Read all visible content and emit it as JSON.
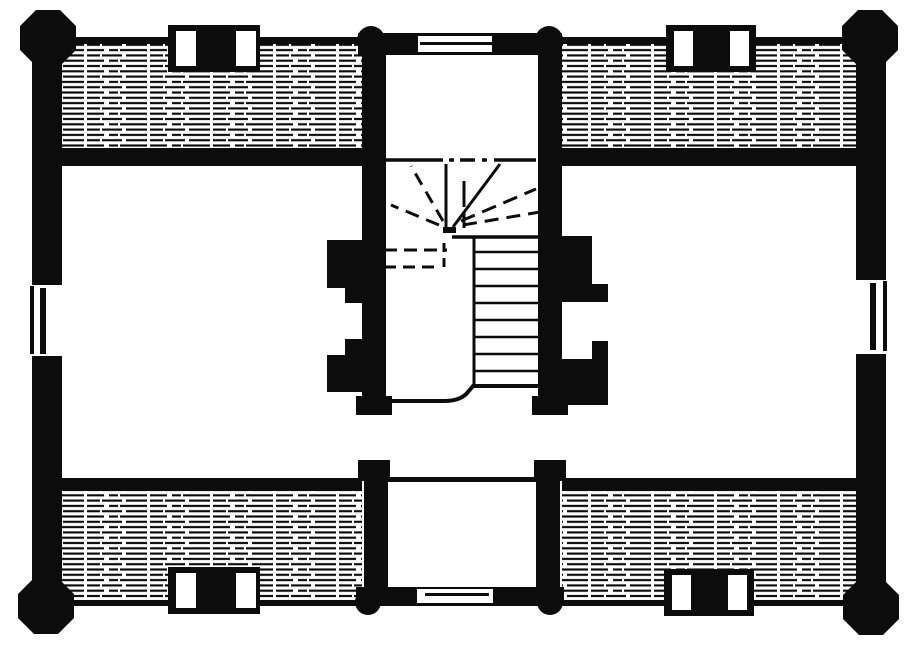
{
  "canvas": {
    "width": 918,
    "height": 652
  },
  "colors": {
    "ink": "#0c0c0c",
    "paper": "#ffffff"
  },
  "diagram": {
    "kind": "architectural-floor-plan-engraving",
    "style": "black-and-white woodcut / line engraving",
    "elements": {
      "corner_posts": 4,
      "small_round_posts": 4,
      "chimneys_with_double_flues": 4,
      "hatched_roof_bands": 4,
      "double_hung_windows": 4,
      "fireplace_jamb_pairs": 2,
      "stair": "central hall stair: dashed winder flight above, straight run of treads descending with curved bottom step line",
      "bays": "projecting entry bays top-center and bottom-center, each with a window in the end wall",
      "rooms": "open white room left and right of the central stair hall"
    }
  }
}
